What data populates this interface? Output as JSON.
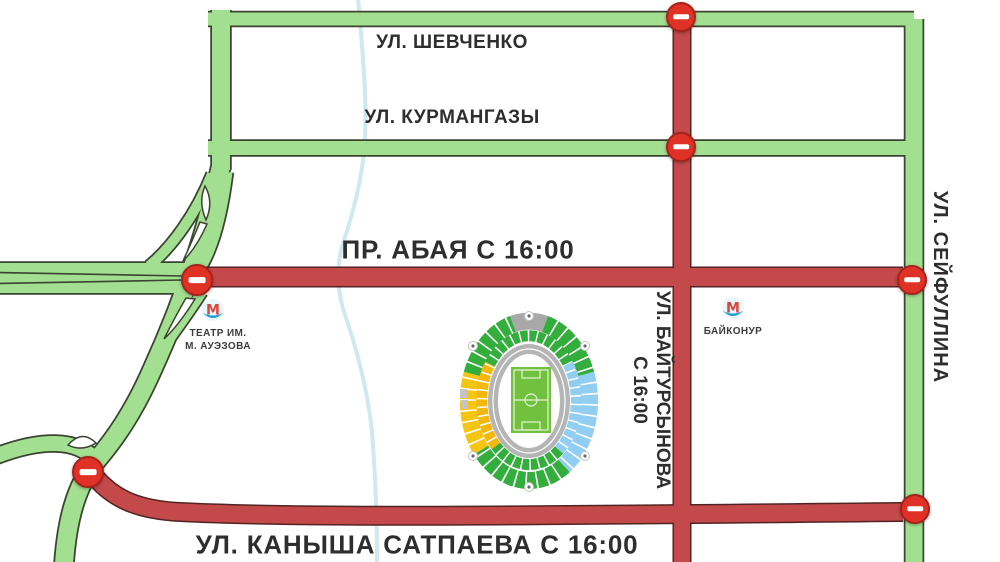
{
  "map": {
    "title_hint": "road closure scheme around Central Stadium",
    "streets": {
      "shevchenko": "УЛ. ШЕВЧЕНКО",
      "kurmangazy": "УЛ. КУРМАНГАЗЫ",
      "abaya": "ПР. АБАЯ С 16:00",
      "satpaeva": "УЛ. КАНЫША САТПАЕВА С 16:00",
      "baytursynova_line1": "УЛ. БАЙТУРСЫНОВА",
      "baytursynova_line2": "С 16:00",
      "seyfullina": "УЛ. СЕЙФУЛЛИНА"
    },
    "metro": {
      "logo_letter": "М",
      "theater_line1": "ТЕАТР ИМ.",
      "theater_line2": "М. АУЭЗОВА",
      "baikonur": "БАЙКОНУР"
    },
    "colors": {
      "open_road": "#a2df90",
      "open_road_border": "#3a4431",
      "closed_road": "#c4494a",
      "closed_road_border": "#512423",
      "river": "#cfe9f1",
      "no_entry_sign": "#e03127"
    },
    "no_entry_signs": [
      {
        "x": 681,
        "y": 17,
        "r": 15
      },
      {
        "x": 681,
        "y": 147,
        "r": 15
      },
      {
        "x": 197,
        "y": 280,
        "r": 16
      },
      {
        "x": 912,
        "y": 280,
        "r": 15
      },
      {
        "x": 88,
        "y": 472,
        "r": 16
      },
      {
        "x": 915,
        "y": 509,
        "r": 15
      }
    ]
  }
}
